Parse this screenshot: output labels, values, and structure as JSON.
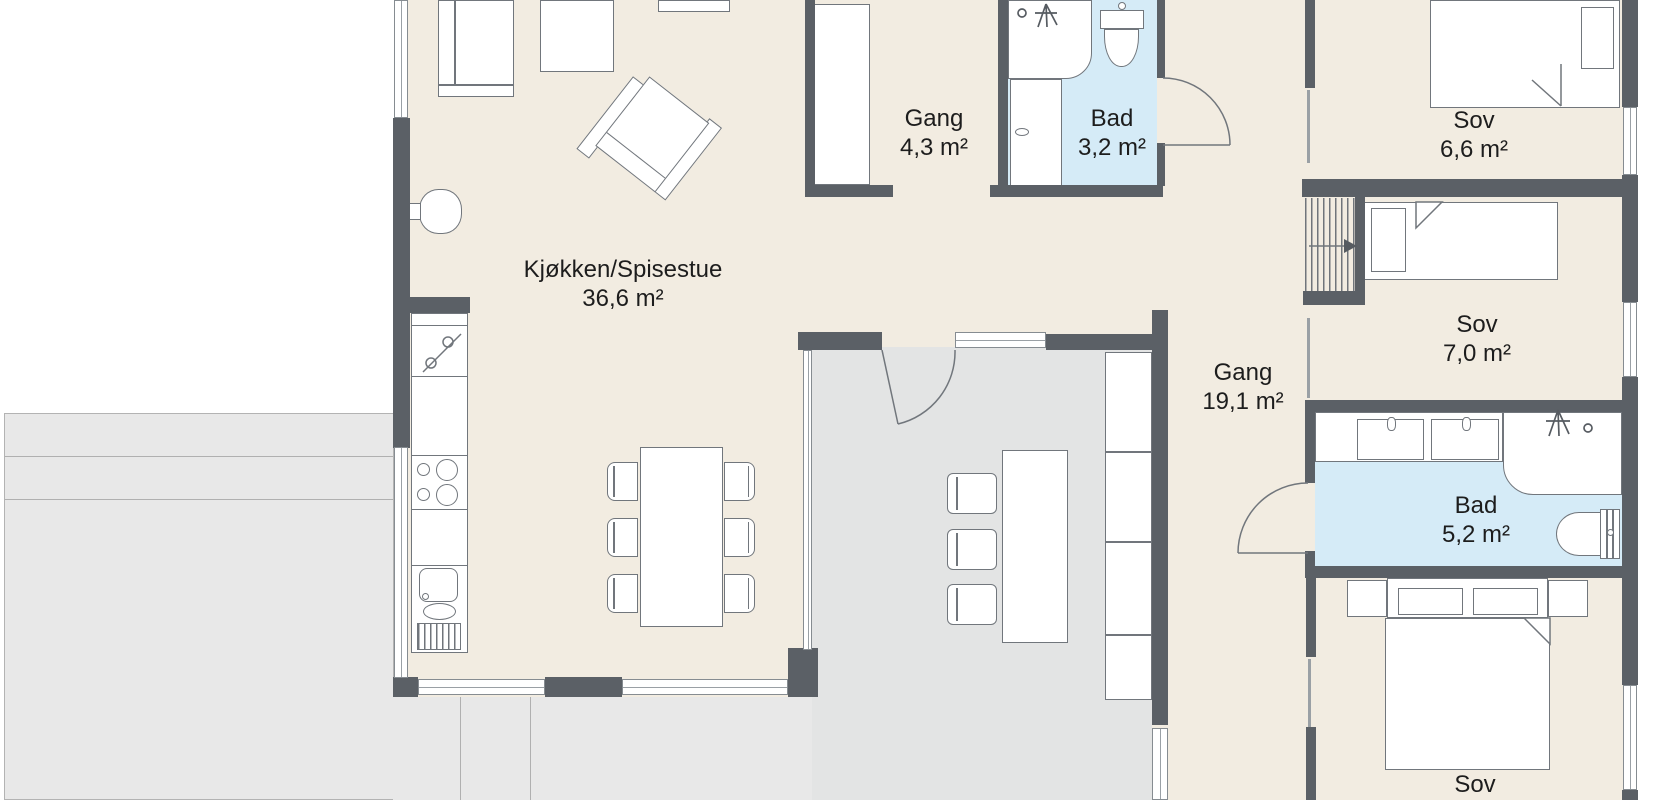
{
  "colors": {
    "wall": "#5b6066",
    "floor": "#f2ece1",
    "bath": "#d5ebf7",
    "room": "#e3e4e4",
    "terrace": "#e8e8e8",
    "outline": "#71767c",
    "text": "#1d1d1d"
  },
  "rooms": {
    "kitchen_dining": {
      "name": "Kjøkken/Spisestue",
      "area": "36,6 m²"
    },
    "hall_entry": {
      "name": "Gang",
      "area": "4,3 m²"
    },
    "bath_small": {
      "name": "Bad",
      "area": "3,2 m²"
    },
    "bedroom_1": {
      "name": "Sov",
      "area": "6,6 m²"
    },
    "bedroom_2": {
      "name": "Sov",
      "area": "7,0 m²"
    },
    "hall_main": {
      "name": "Gang",
      "area": "19,1 m²"
    },
    "bath_main": {
      "name": "Bad",
      "area": "5,2 m²"
    },
    "bedroom_3": {
      "name": "Sov"
    }
  }
}
